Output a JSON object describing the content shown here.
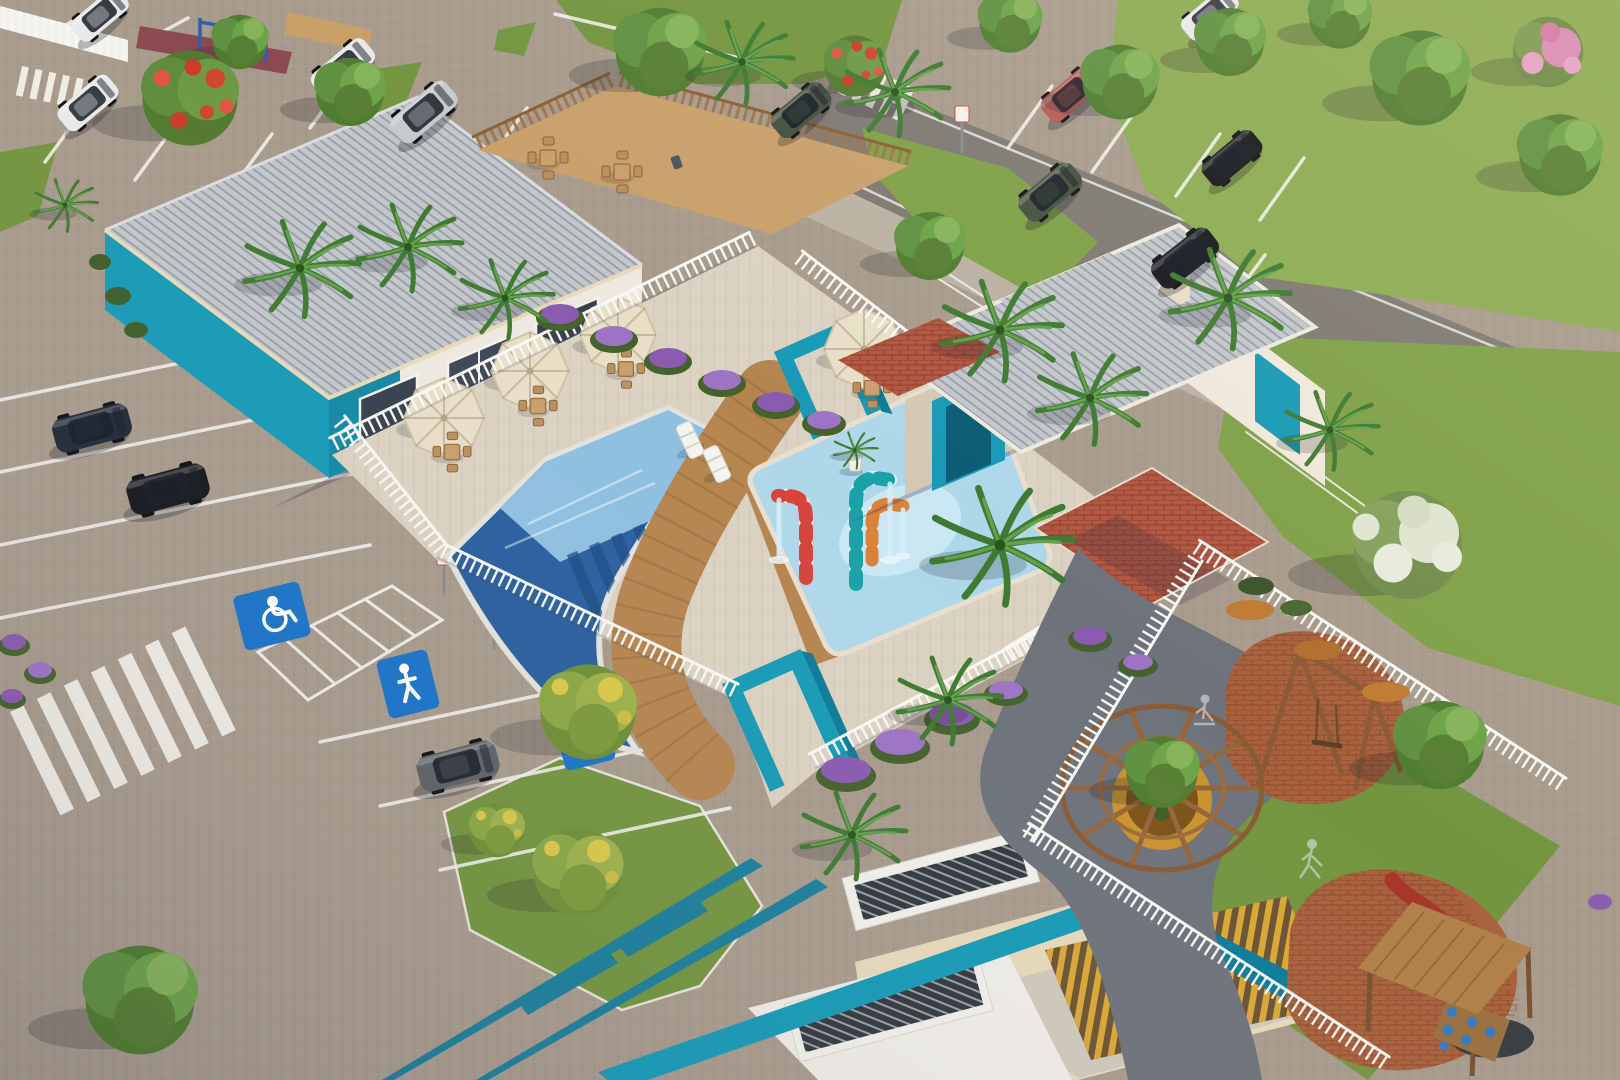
{
  "scene": {
    "medium": "aerial 3D architectural rendering",
    "subject": "residential condominium leisure area with pool, clubhouse, parking lots and playground",
    "lighting": "low warm sun from upper right with long shadows",
    "canvas": {
      "width": 1620,
      "height": 1080
    }
  },
  "palette": {
    "ground": "#a89b8c",
    "deck": "#dcd2c2",
    "asphalt": "#7e7972",
    "sidewalk": "#bbb2a4",
    "grass": "#73953f",
    "grass_light": "#8cab52",
    "grass_dark": "#4c672c",
    "roof": "#c3c7cb",
    "wall_white": "#eee9e0",
    "wall_cream": "#e7d8ba",
    "wall_shade": "#d5c8b2",
    "teal": "#179ab6",
    "teal_dark": "#0d7c98",
    "pool_deep": "#2a5f9e",
    "pool_shallow": "#8fc0e0",
    "pool_kids": "#aed8ea",
    "pool_splash": "#cdeaf5",
    "wood": "#b5854f",
    "wood_fence": "#a0744a",
    "fence_white": "#f6f6f2",
    "brick_red": "#b25640",
    "terracotta": "#a9613d",
    "umbrella": "#e9dfc7",
    "sign_blue": "#1a73c8",
    "flower_purple": "#8a5bb0",
    "flower_orange": "#c07a33",
    "slat_yellow": "#d9a833",
    "planter_yellow": "#c9932e",
    "cane_red": "#d84338",
    "cane_teal": "#19a2a8",
    "cane_orange": "#d8823a",
    "shadow": "rgba(45,40,65,0.28)"
  },
  "inventory": {
    "buildings": [
      {
        "name": "clubhouse",
        "walls": "white with teal corner",
        "roof": "gray corrugated metal"
      },
      {
        "name": "pool-pavilion",
        "walls": "cream with teal arch portals and cobogo blocks",
        "roof": "gray corrugated metal"
      },
      {
        "name": "entrance-portico",
        "features": [
          "teal pergola beams",
          "teal parapet",
          "yellow timber slats",
          "corrugated skylights"
        ]
      }
    ],
    "pool_area": {
      "main_pool": {
        "water": "deep blue with lap lanes",
        "tanning_ledge": true,
        "loungers": 2
      },
      "kids_splash_pool": {
        "water": "light blue",
        "spouts": [
          "red-white candy cane",
          "teal-white candy cane",
          "orange-white candy cane"
        ]
      },
      "deck": [
        "timber walkway",
        "cream pavers",
        "white picket fence",
        "two teal entry arches"
      ],
      "umbrellas": 4,
      "table_sets": 4,
      "planters": 2
    },
    "parking": {
      "surface": "interlocking pavers and asphalt drive",
      "markings": [
        "white stall lines",
        "zebra crosswalks",
        "hatched no-parking zone"
      ],
      "pavement_signs": [
        "wheelchair-accessible",
        "family-priority",
        "family-priority"
      ],
      "cars": [
        {
          "color": "white",
          "type": "hatchback"
        },
        {
          "color": "white",
          "type": "sedan"
        },
        {
          "color": "silver",
          "type": "suv"
        },
        {
          "color": "dark navy",
          "type": "hatchback"
        },
        {
          "color": "black",
          "type": "suv"
        },
        {
          "color": "gray",
          "type": "suv"
        },
        {
          "color": "red",
          "type": "sedan"
        },
        {
          "color": "dark green",
          "type": "suv"
        },
        {
          "color": "black",
          "type": "hatchback"
        },
        {
          "color": "black",
          "type": "suv"
        },
        {
          "color": "white",
          "type": "sedan"
        },
        {
          "color": "dark green",
          "type": "minivan"
        },
        {
          "color": "white",
          "type": "suv"
        }
      ]
    },
    "playground": {
      "surfaces": [
        "terracotta brick pads",
        "charcoal path",
        "lawn"
      ],
      "equipment": [
        "timber dome pergola over planter",
        "a-frame swing set",
        "timber play tower with red slide and blue climbing holds"
      ],
      "figures": [
        "child on scooter",
        "running child"
      ]
    },
    "vegetation": {
      "palms": 13,
      "shade_trees": 14,
      "flowering_trees": [
        "red flamboyant",
        "pink trumpet",
        "white blossom",
        "yellow ipe"
      ],
      "hedges": [
        "purple flowers",
        "orange flowers",
        "green shrubs"
      ]
    },
    "extras": [
      "bbq patio with timber fence and dining sets",
      "outdoor gym court",
      "accessibility ramps with white handrails"
    ]
  },
  "icons": {
    "wheelchair_symbol": "wheelchair pictogram on blue square",
    "family_symbol": "person pictogram on blue square"
  }
}
